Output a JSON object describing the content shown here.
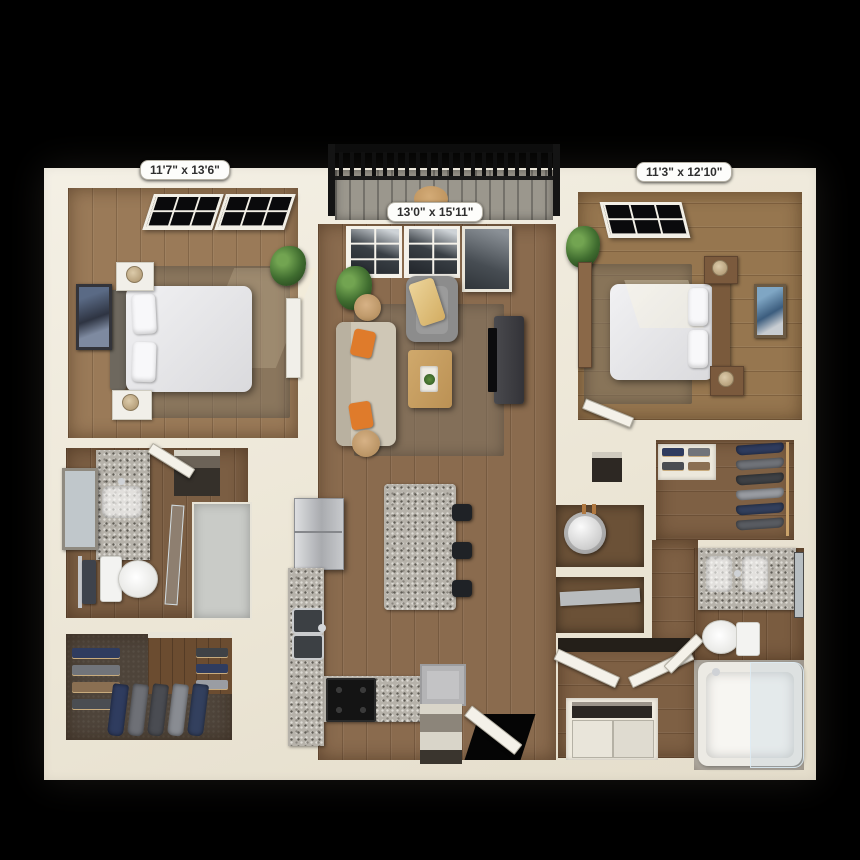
{
  "scene": {
    "kind": "3d-floor-plan-render",
    "background": "#000000"
  },
  "labels": {
    "bedroom_left": "11'7\" x 13'6\"",
    "living_room": "13'0\" x 15'11\"",
    "bedroom_right": "11'3\" x 12'10\""
  },
  "palette": {
    "walls": "#f0ebdf",
    "wood_floor_living": "#8a6b4e",
    "wood_floor_bedroom": "#9a7a58",
    "closet_carpet": "#4e443a",
    "granite": "#b6b2aa",
    "balcony_railing": "#141414",
    "sofa": "#cfc7b6",
    "accent_pillow": "#df7b2b",
    "bed_linen": "#e9e9eb",
    "plant": "#3f6c2f"
  }
}
